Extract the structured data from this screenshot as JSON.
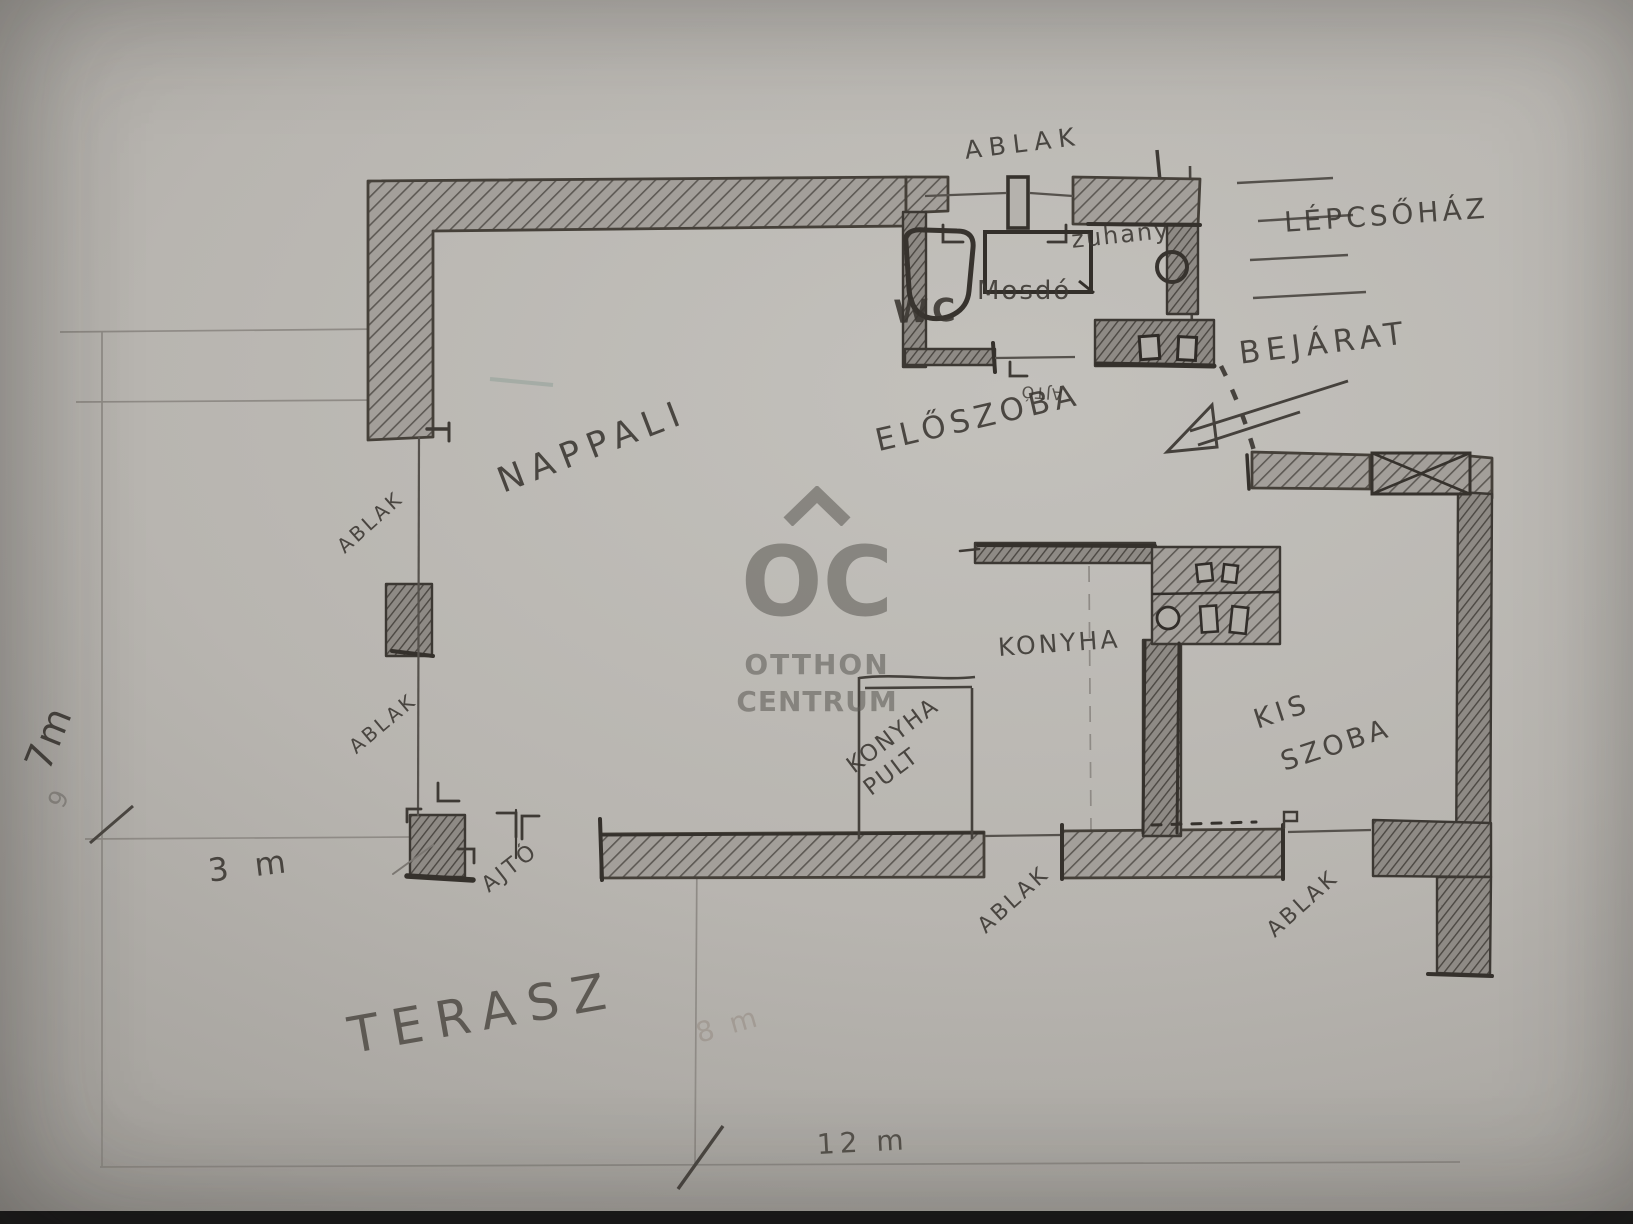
{
  "watermark": {
    "logo_text": "OC",
    "brand_line1": "OTTHON",
    "brand_line2": "CENTRUM"
  },
  "rooms": {
    "nappali": "NAPPALI",
    "eloszoba": "ELŐSZOBA",
    "konyha": "KONYHA",
    "konyha_pult_line1": "KONYHA",
    "konyha_pult_line2": "PULT",
    "kis_szoba_line1": "KIS",
    "kis_szoba_line2": "SZOBA",
    "terasz": "TERASZ",
    "wc": "WC",
    "mosdo": "Mosdó",
    "zuhany": "zuhany",
    "lepcsohaz": "LÉPCSŐHÁZ"
  },
  "annotations": {
    "bejarat": "BEJÁRAT",
    "ablak": "ABLAK",
    "ajto": "AJTÓ"
  },
  "dimensions": {
    "total_width": "12 m",
    "left_height": "7m",
    "left_height_faint": "9",
    "terasz_left": "3 m",
    "terasz_depth": "8 m"
  },
  "colors": {
    "paper": "#b8b5b0",
    "pencil_dark": "#3a3631",
    "pencil_mid": "#57534e",
    "pencil_light": "#8f8b86",
    "watermark_gray": "#5a5752",
    "photo_edge": "#171717"
  }
}
